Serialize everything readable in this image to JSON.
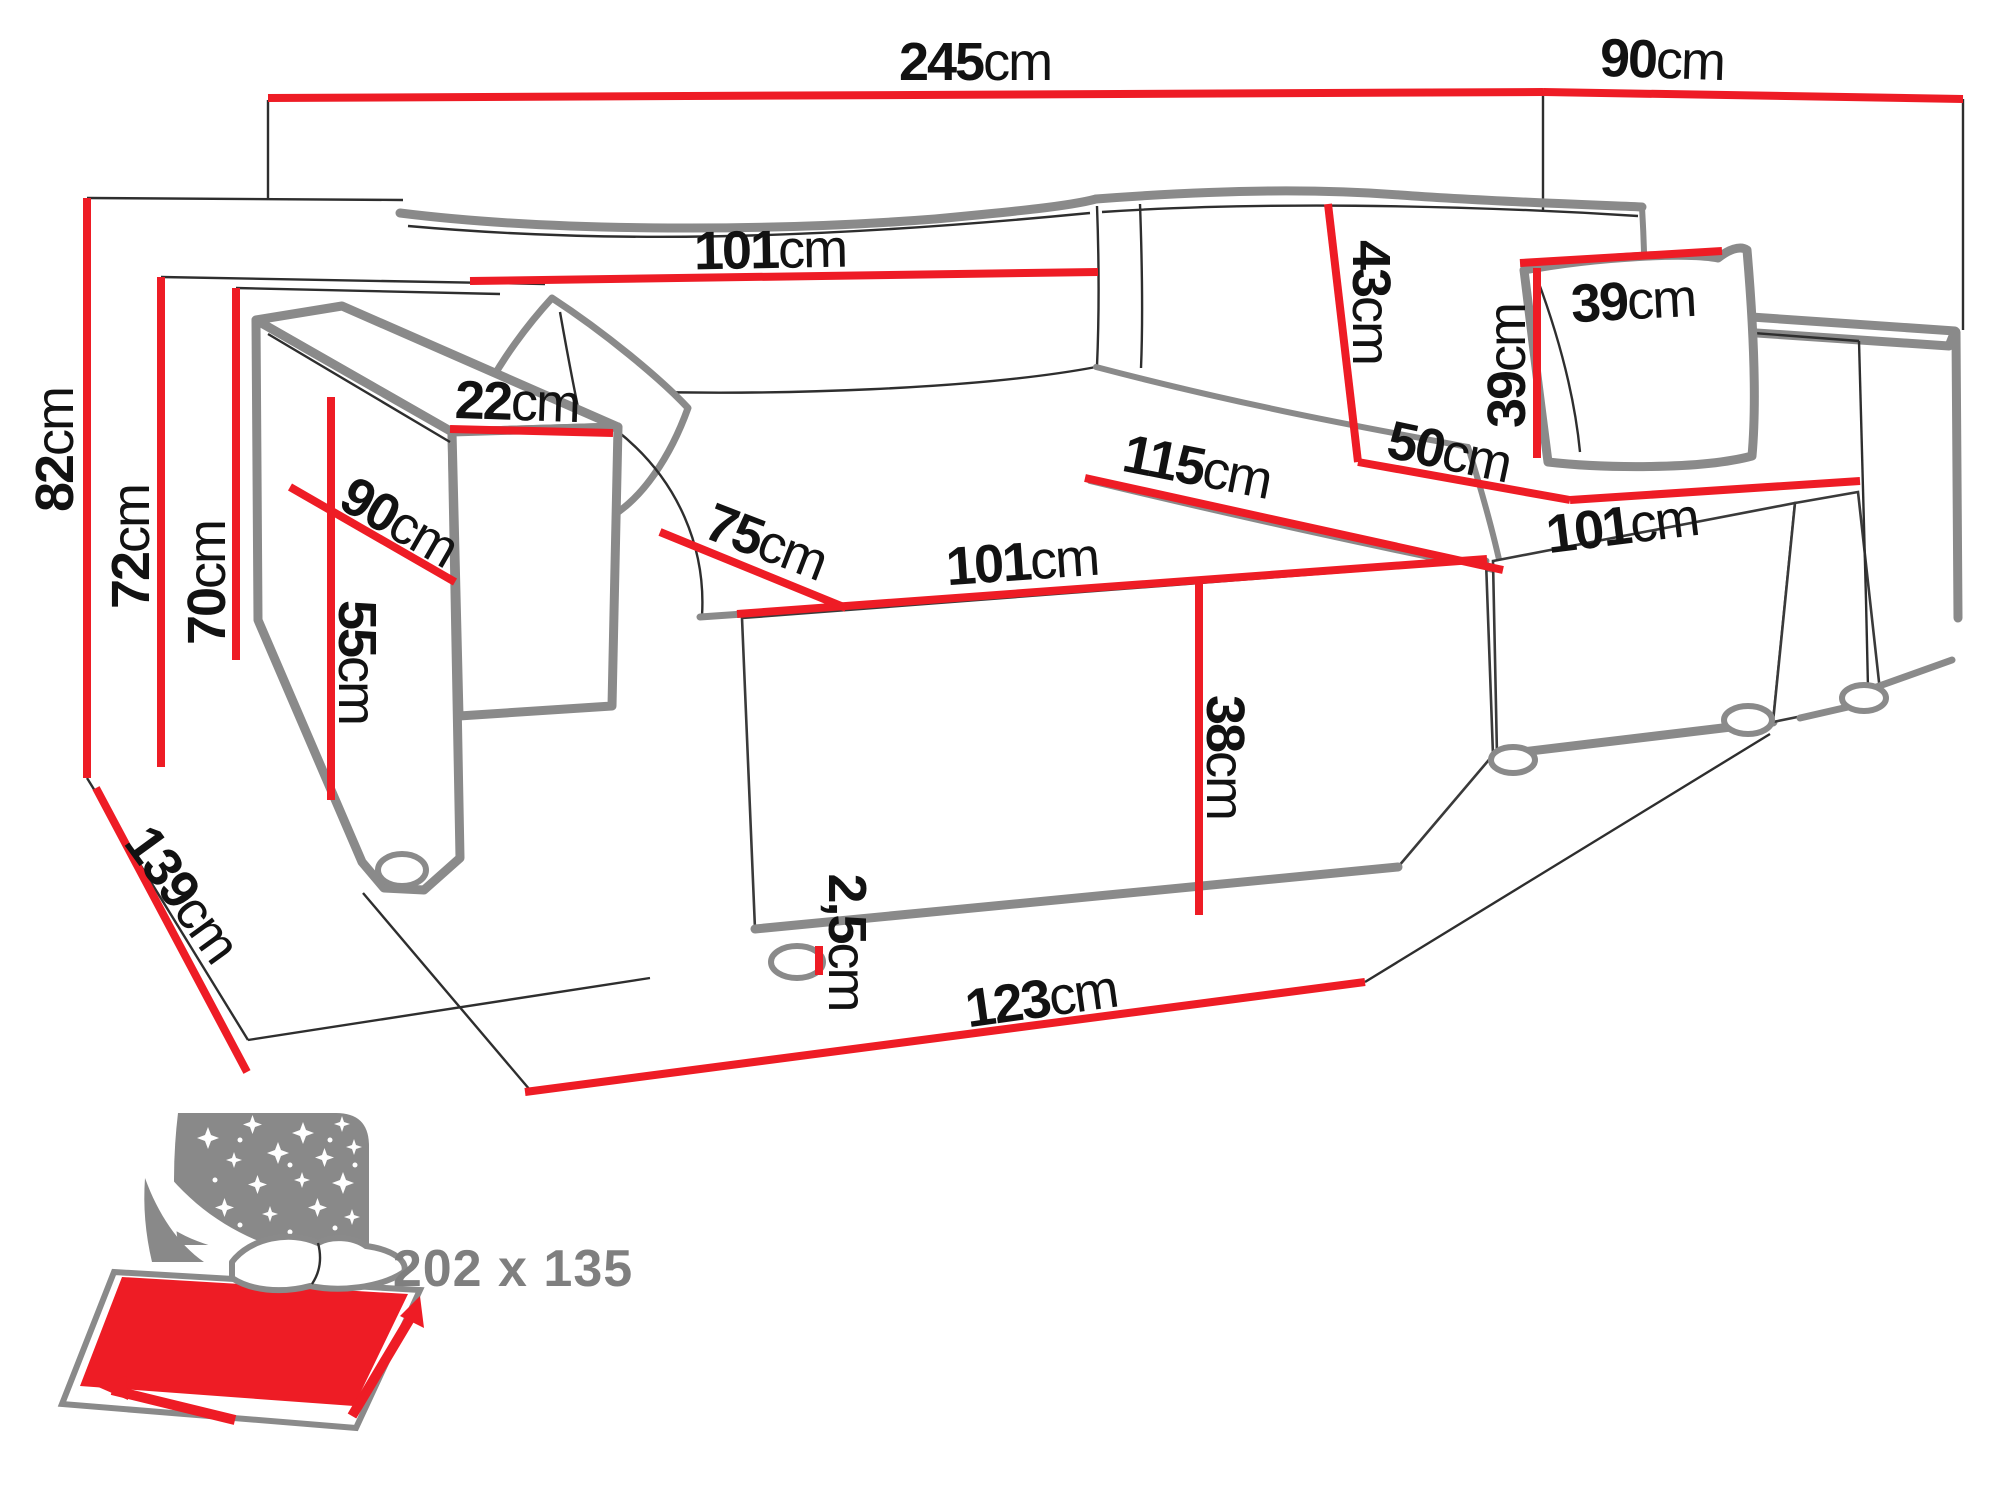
{
  "page": {
    "background": "#ffffff",
    "kind": "furniture dimension diagram",
    "subject": "corner sofa bed with chaise"
  },
  "colors": {
    "dimension_red": "#ee1c25",
    "outline_gray": "#8a8a8a",
    "line_black": "#2e2e2e",
    "icon_gray": "#898989",
    "label_black": "#121212",
    "bed_text_gray": "#7f7f7f"
  },
  "sofa_diagram": {
    "unit": "cm",
    "dimensions": [
      {
        "id": "total-width",
        "value": "245",
        "unit": "cm",
        "x": 975,
        "y": 62,
        "rotate": 0,
        "line": {
          "x1": 268,
          "y1": 98,
          "x2": 1543,
          "y2": 92
        }
      },
      {
        "id": "total-depth-top",
        "value": "90",
        "unit": "cm",
        "x": 1662,
        "y": 60,
        "rotate": 2,
        "line": {
          "x1": 1543,
          "y1": 92,
          "x2": 1963,
          "y2": 99
        }
      },
      {
        "id": "backrest-width",
        "value": "101",
        "unit": "cm",
        "x": 770,
        "y": 250,
        "rotate": -1,
        "line": {
          "x1": 470,
          "y1": 281,
          "x2": 1098,
          "y2": 272
        }
      },
      {
        "id": "backrest-cushion-height",
        "value": "43",
        "unit": "cm",
        "x": 1371,
        "y": 302,
        "rotate": 90,
        "line": {
          "x1": 1328,
          "y1": 204,
          "x2": 1358,
          "y2": 462
        }
      },
      {
        "id": "pillow-width",
        "value": "39",
        "unit": "cm",
        "x": 1633,
        "y": 301,
        "rotate": -3,
        "line": {
          "x1": 1520,
          "y1": 263,
          "x2": 1722,
          "y2": 251
        }
      },
      {
        "id": "pillow-height",
        "value": "39",
        "unit": "cm",
        "x": 1507,
        "y": 366,
        "rotate": -90,
        "line": {
          "x1": 1537,
          "y1": 268,
          "x2": 1537,
          "y2": 458
        }
      },
      {
        "id": "chaise-seat-depth",
        "value": "50",
        "unit": "cm",
        "x": 1449,
        "y": 452,
        "rotate": 12,
        "line": {
          "x1": 1358,
          "y1": 462,
          "x2": 1570,
          "y2": 500
        }
      },
      {
        "id": "seat-diagonal",
        "value": "115",
        "unit": "cm",
        "x": 1197,
        "y": 467,
        "rotate": 11,
        "line": {
          "x1": 1085,
          "y1": 478,
          "x2": 1503,
          "y2": 570
        }
      },
      {
        "id": "seat-cushion-width",
        "value": "101",
        "unit": "cm",
        "x": 1022,
        "y": 562,
        "rotate": -4,
        "line": {
          "x1": 737,
          "y1": 614,
          "x2": 1487,
          "y2": 559
        }
      },
      {
        "id": "chaise-length",
        "value": "101",
        "unit": "cm",
        "x": 1622,
        "y": 526,
        "rotate": -7,
        "line": {
          "x1": 1570,
          "y1": 500,
          "x2": 1860,
          "y2": 481
        }
      },
      {
        "id": "seat-depth",
        "value": "75",
        "unit": "cm",
        "x": 766,
        "y": 542,
        "rotate": 21,
        "line": {
          "x1": 660,
          "y1": 532,
          "x2": 846,
          "y2": 608
        }
      },
      {
        "id": "armrest-width",
        "value": "22",
        "unit": "cm",
        "x": 517,
        "y": 402,
        "rotate": 2,
        "line": {
          "x1": 450,
          "y1": 429,
          "x2": 613,
          "y2": 433
        }
      },
      {
        "id": "armrest-depth",
        "value": "90",
        "unit": "cm",
        "x": 399,
        "y": 522,
        "rotate": 30,
        "line": {
          "x1": 290,
          "y1": 487,
          "x2": 455,
          "y2": 582
        }
      },
      {
        "id": "armrest-height",
        "value": "55",
        "unit": "cm",
        "x": 357,
        "y": 662,
        "rotate": 90,
        "line": {
          "x1": 331,
          "y1": 397,
          "x2": 331,
          "y2": 800
        }
      },
      {
        "id": "seat-front-height",
        "value": "38",
        "unit": "cm",
        "x": 1225,
        "y": 757,
        "rotate": 90,
        "line": {
          "x1": 1199,
          "y1": 582,
          "x2": 1199,
          "y2": 915
        }
      },
      {
        "id": "leg-height",
        "value": "2,5",
        "unit": "cm",
        "x": 847,
        "y": 942,
        "rotate": 90,
        "line": {
          "x1": 819,
          "y1": 946,
          "x2": 819,
          "y2": 975
        }
      },
      {
        "id": "front-bottom-width",
        "value": "123",
        "unit": "cm",
        "x": 1041,
        "y": 999,
        "rotate": -8,
        "line": {
          "x1": 525,
          "y1": 1092,
          "x2": 1365,
          "y2": 982
        }
      },
      {
        "id": "floor-depth",
        "value": "139",
        "unit": "cm",
        "x": 182,
        "y": 894,
        "rotate": 54,
        "line": {
          "x1": 96,
          "y1": 788,
          "x2": 247,
          "y2": 1072
        }
      },
      {
        "id": "total-height",
        "value": "82",
        "unit": "cm",
        "x": 55,
        "y": 450,
        "rotate": -90,
        "line": {
          "x1": 87,
          "y1": 198,
          "x2": 87,
          "y2": 778
        }
      },
      {
        "id": "backrest-height",
        "value": "72",
        "unit": "cm",
        "x": 131,
        "y": 547,
        "rotate": -90,
        "line": {
          "x1": 161,
          "y1": 277,
          "x2": 161,
          "y2": 767
        }
      },
      {
        "id": "armrest-top-height",
        "value": "70",
        "unit": "cm",
        "x": 207,
        "y": 583,
        "rotate": -90,
        "line": {
          "x1": 236,
          "y1": 288,
          "x2": 236,
          "y2": 660
        }
      }
    ]
  },
  "bed_icon": {
    "label": "202 x 135",
    "meaning": "sleeping surface size in cm"
  }
}
